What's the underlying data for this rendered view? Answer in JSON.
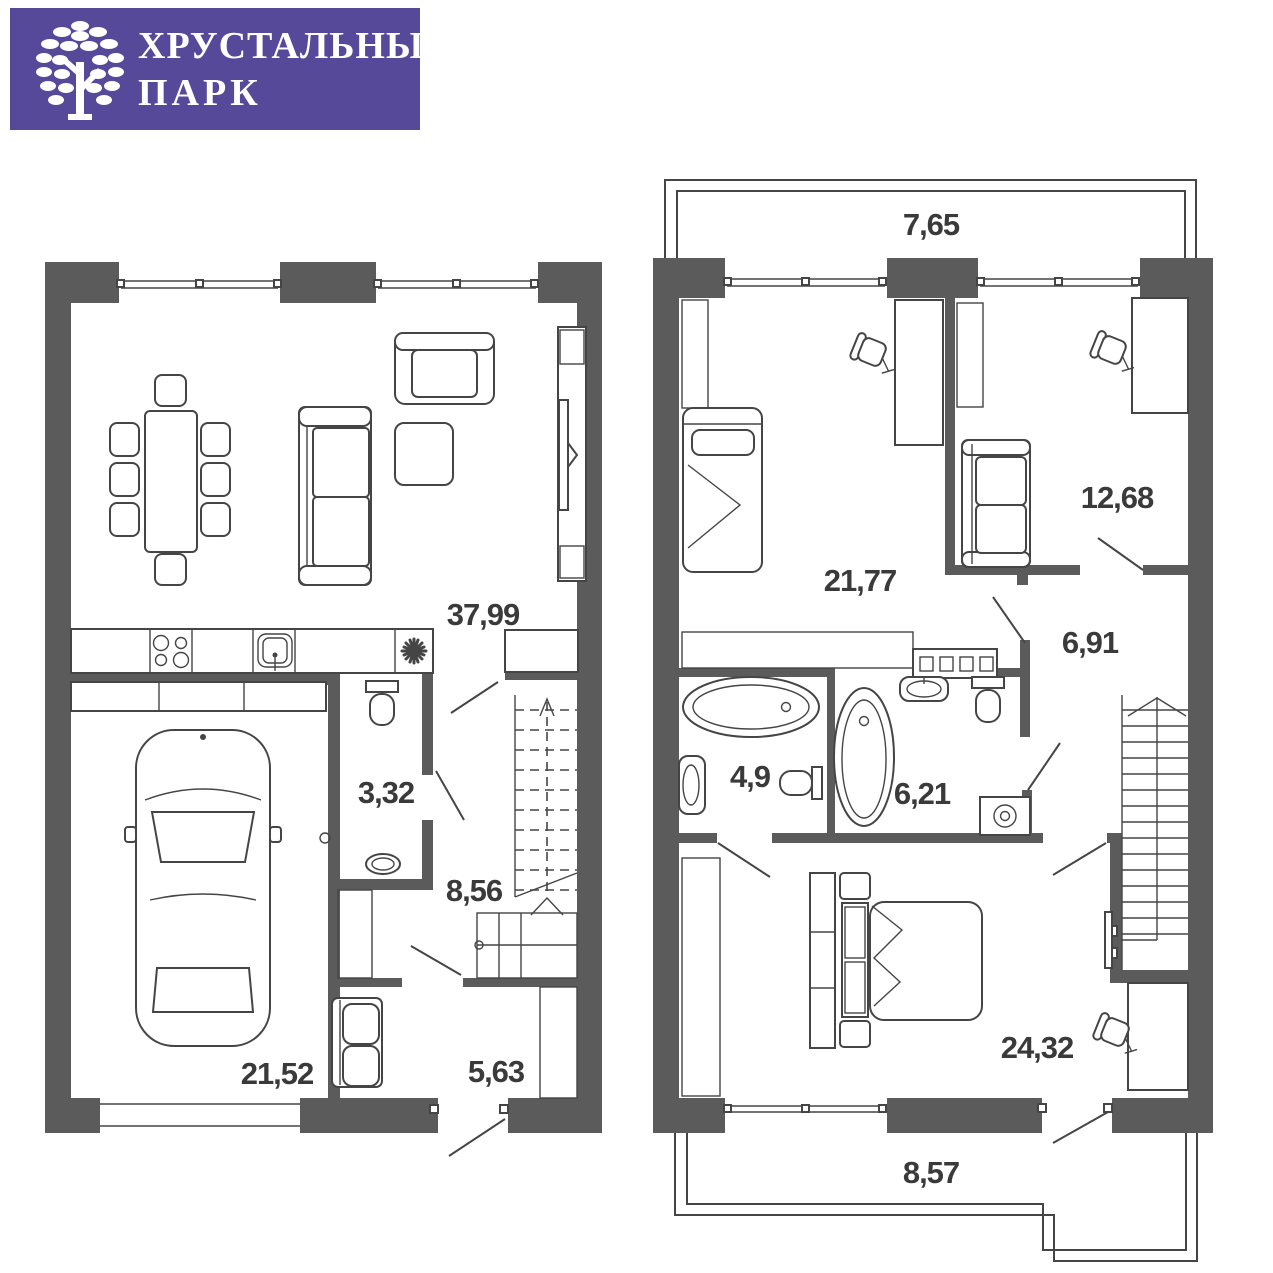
{
  "logo": {
    "line1": "ХРУСТАЛЬНЫЙ",
    "line2": "ПАРК"
  },
  "floor1": {
    "rooms": {
      "living_kitchen": "37,99",
      "wc": "3,32",
      "hall": "8,56",
      "garage": "21,52",
      "storage": "5,63"
    }
  },
  "floor2": {
    "rooms": {
      "balcony_top": "7,65",
      "bedroom_left": "21,77",
      "bedroom_right": "12,68",
      "hall": "6,91",
      "bathroom_left": "4,9",
      "bathroom_right": "6,21",
      "bedroom_master": "24,32",
      "balcony_bottom": "8,57"
    }
  },
  "colors": {
    "brand": "#57499a",
    "wall": "#5b5b5b",
    "line": "#454545",
    "label": "#3a3a3a"
  }
}
